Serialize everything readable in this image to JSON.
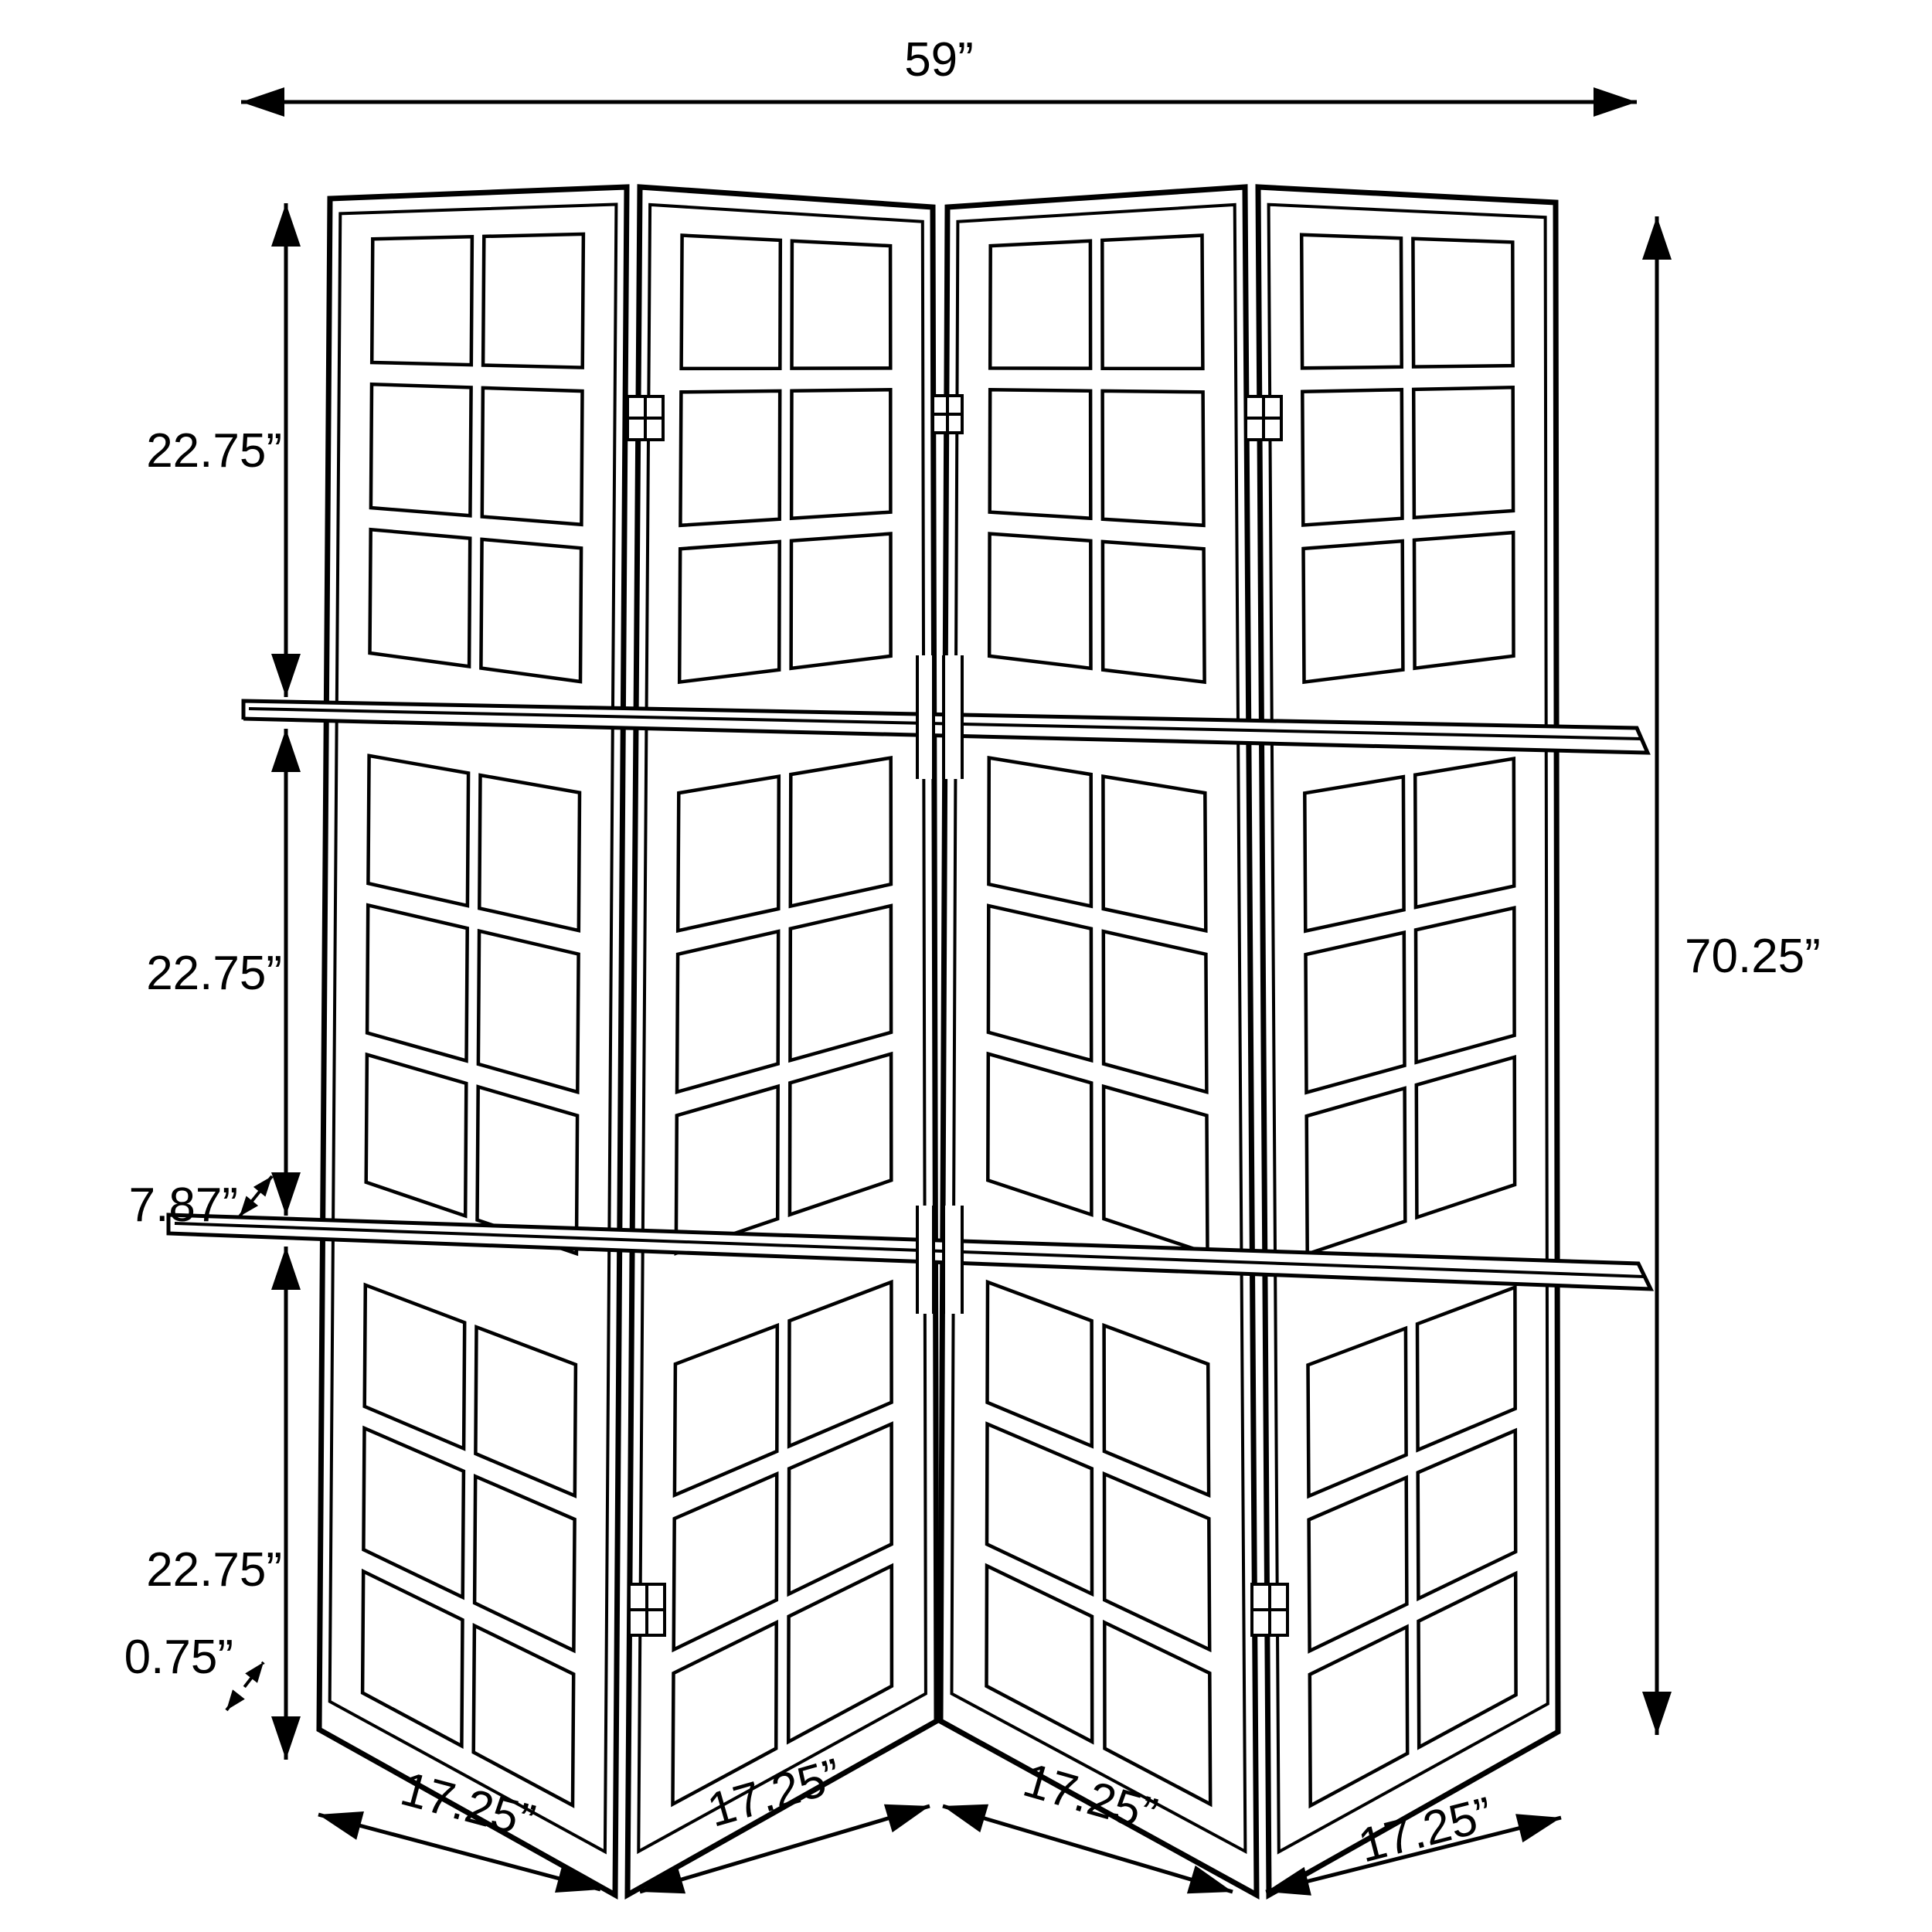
{
  "diagram": {
    "type": "product-dimension-drawing",
    "subject": "four-panel folding room divider screen with two display shelves",
    "background_color": "#ffffff",
    "line_color": "#000000",
    "panel_count": 4,
    "shelf_count": 2,
    "panes_per_panel_columns": 2,
    "panes_per_panel_rows": 9,
    "dimensions": {
      "overall_width": "59”",
      "overall_height": "70.25”",
      "section_heights": [
        "22.75”",
        "22.75”",
        "22.75”"
      ],
      "shelf_depth": "7.87”",
      "frame_thickness": "0.75”",
      "panel_widths": [
        "17.25”",
        "17.25”",
        "17.25”",
        "17.25”"
      ]
    }
  }
}
